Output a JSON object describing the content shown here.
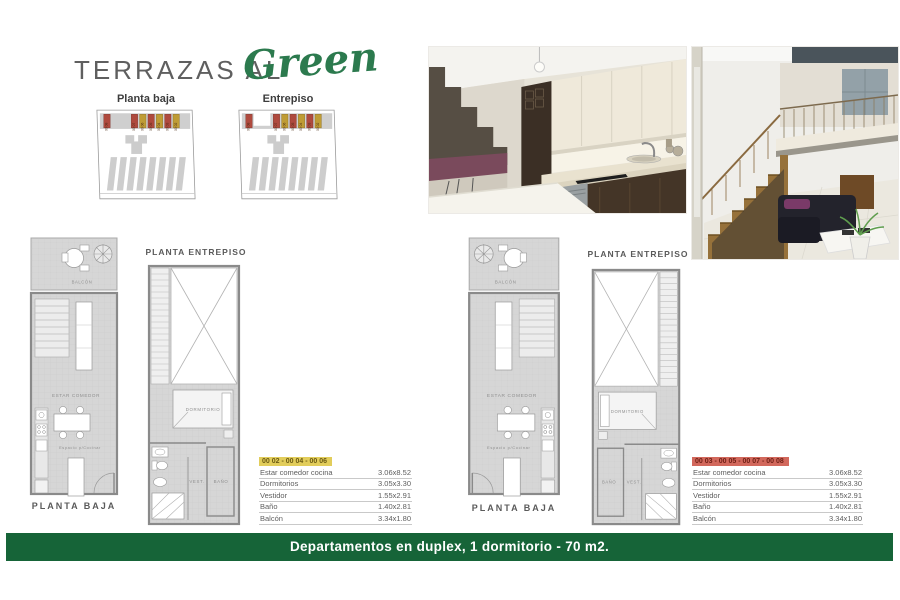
{
  "header": {
    "title_main": "TERRAZAS AL",
    "title_script": "Green"
  },
  "site_plans": {
    "baja_label": "Planta baja",
    "entrepiso_label": "Entrepiso",
    "unit_ids": [
      "00 08",
      "00 07",
      "00 06",
      "00 05",
      "00 04",
      "00 03",
      "00 02"
    ]
  },
  "plans": {
    "entrepiso_title": "PLANTA ENTREPISO",
    "baja_title": "PLANTA BAJA",
    "balcon": "BALCÓN",
    "estar": "ESTAR COMEDOR",
    "cocinar": "Espacio p/Cocinar",
    "dormitorio": "DORMITORIO",
    "vest": "VEST.",
    "bano": "BAÑO"
  },
  "tables": [
    {
      "header": "00 02 - 00 04 - 00 06",
      "accent": "#E2CD5B",
      "rows": [
        {
          "label": "Estar comedor cocina",
          "value": "3.06x8.52"
        },
        {
          "label": "Dormitorios",
          "value": "3.05x3.30"
        },
        {
          "label": "Vestidor",
          "value": "1.55x2.91"
        },
        {
          "label": "Baño",
          "value": "1.40x2.81"
        },
        {
          "label": "Balcón",
          "value": "3.34x1.80"
        }
      ]
    },
    {
      "header": "00 03 - 00 05 - 00 07 - 00 08",
      "accent": "#D2685C",
      "rows": [
        {
          "label": "Estar comedor cocina",
          "value": "3.06x8.52"
        },
        {
          "label": "Dormitorios",
          "value": "3.05x3.30"
        },
        {
          "label": "Vestidor",
          "value": "1.55x2.91"
        },
        {
          "label": "Baño",
          "value": "1.40x2.81"
        },
        {
          "label": "Balcón",
          "value": "3.34x1.80"
        }
      ]
    }
  ],
  "banner": {
    "text": "Departamentos en duplex, 1 dormitorio - 70 m2."
  },
  "colors": {
    "banner_green": "#166438",
    "script_green": "#2C7A4E",
    "unit_red": "#AF4A3E",
    "unit_yellow": "#BF9C35",
    "table_yellow": "#E2CD5B",
    "table_red": "#D2685C"
  }
}
